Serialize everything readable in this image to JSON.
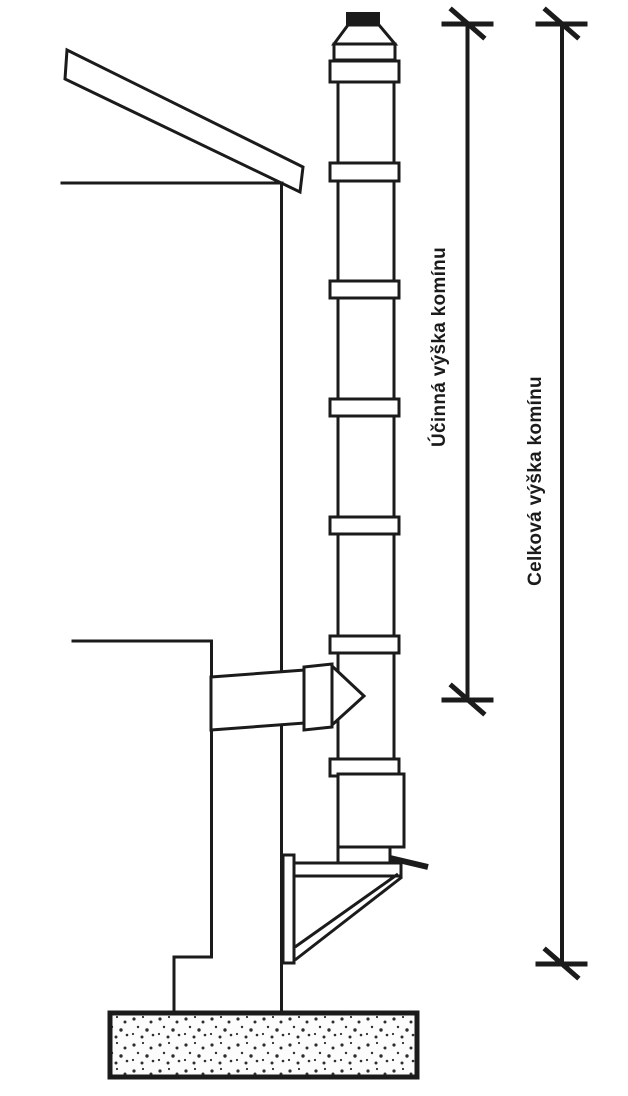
{
  "figure": {
    "labels": {
      "effective_height": "Účinná výška komínu",
      "total_height": "Celková výška komínu"
    },
    "colors": {
      "line": "#1b1b1b",
      "background": "#ffffff",
      "cap_fill": "#1b1b1b",
      "foundation_dot": "#2e2e2e"
    }
  }
}
